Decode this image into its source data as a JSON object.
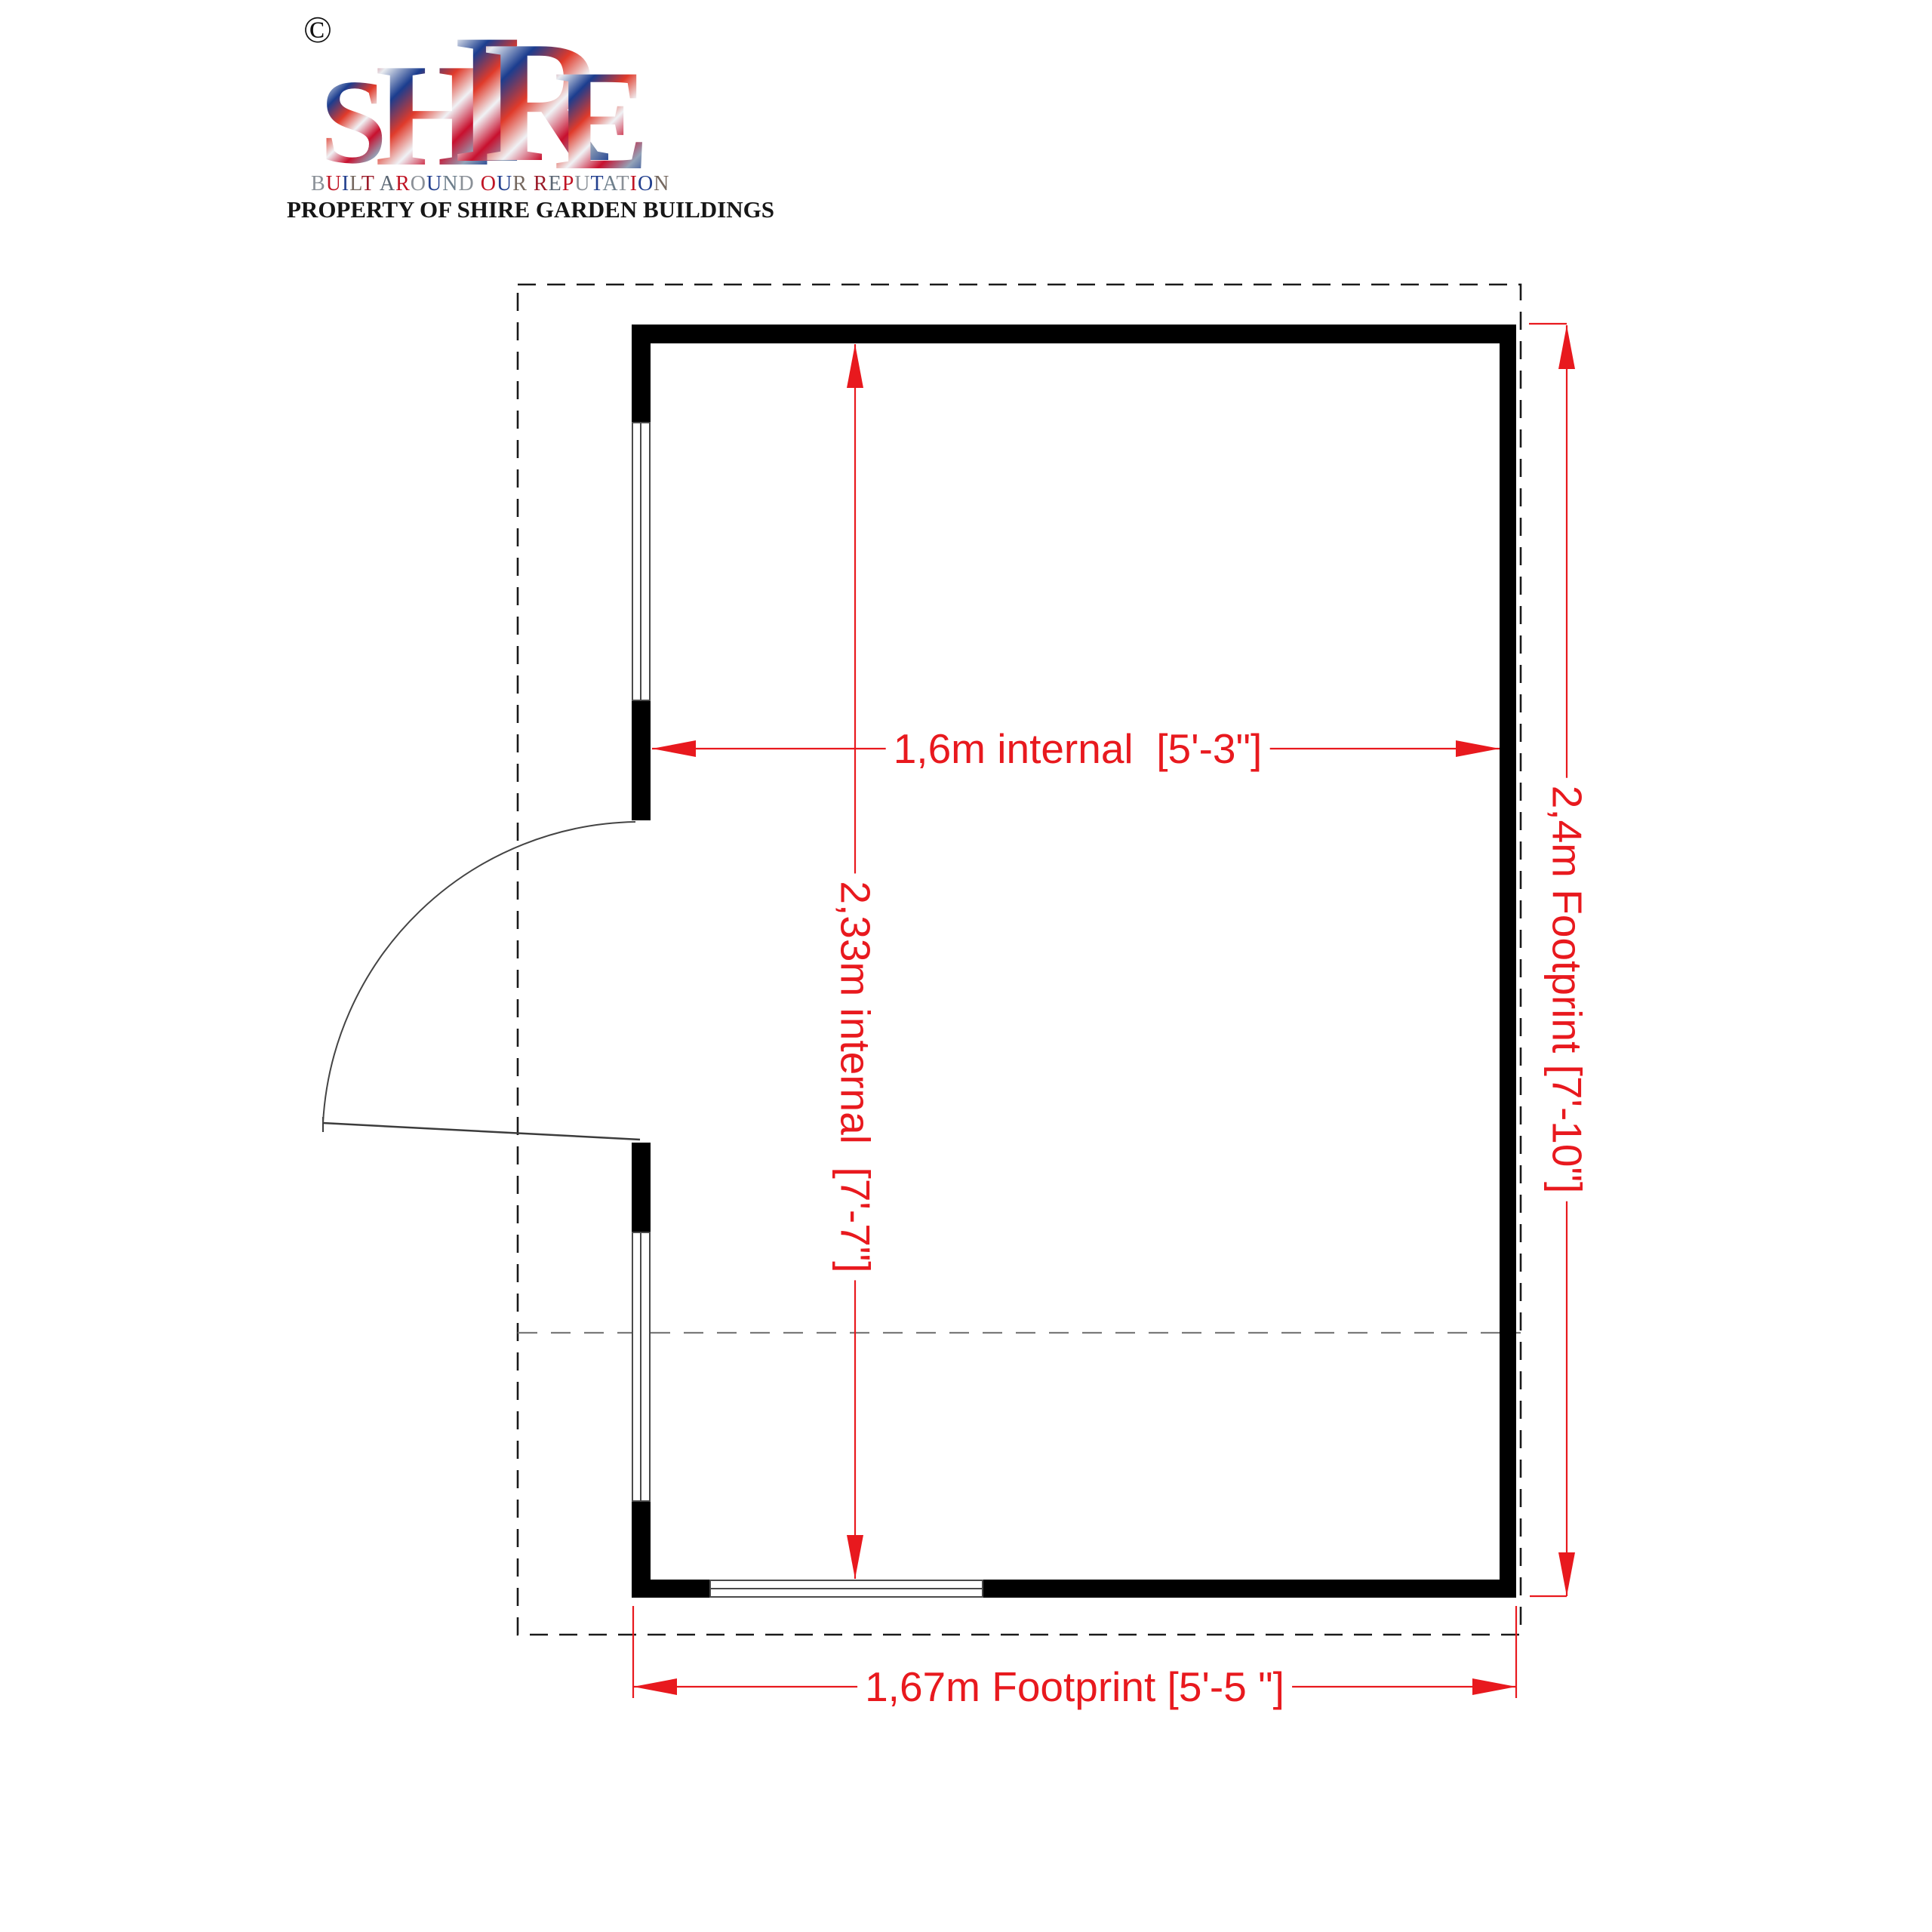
{
  "logo": {
    "copyright": "©",
    "brand": "SHIRE",
    "tagline": "BUILT AROUND OUR REPUTATION",
    "property_line": "PROPERTY OF SHIRE GARDEN BUILDINGS",
    "tagline_palette": [
      "#8a9097",
      "#c01424",
      "#23408e",
      "#75685f",
      "#9b1b2a",
      "#5a6673",
      "#c01424",
      "#8a9097",
      "#23408e",
      "#6e7f8c"
    ]
  },
  "plan": {
    "labels": {
      "internal_width": "1,6m internal  [5'-3\"]",
      "internal_depth": "2,33m internal  [7'-7\"]",
      "footprint_depth": "2,4m Footprint [7'-10\"]",
      "footprint_width": "1,67m Footprint [5'-5 \"]"
    },
    "colors": {
      "dimension_red": "#e8191e",
      "wall_black": "#000000",
      "window_frame_gray": "#4a4a4a",
      "dashed_outline_dark": "#1a1a1a",
      "dashed_interior_gray": "#7a7a7a"
    }
  }
}
